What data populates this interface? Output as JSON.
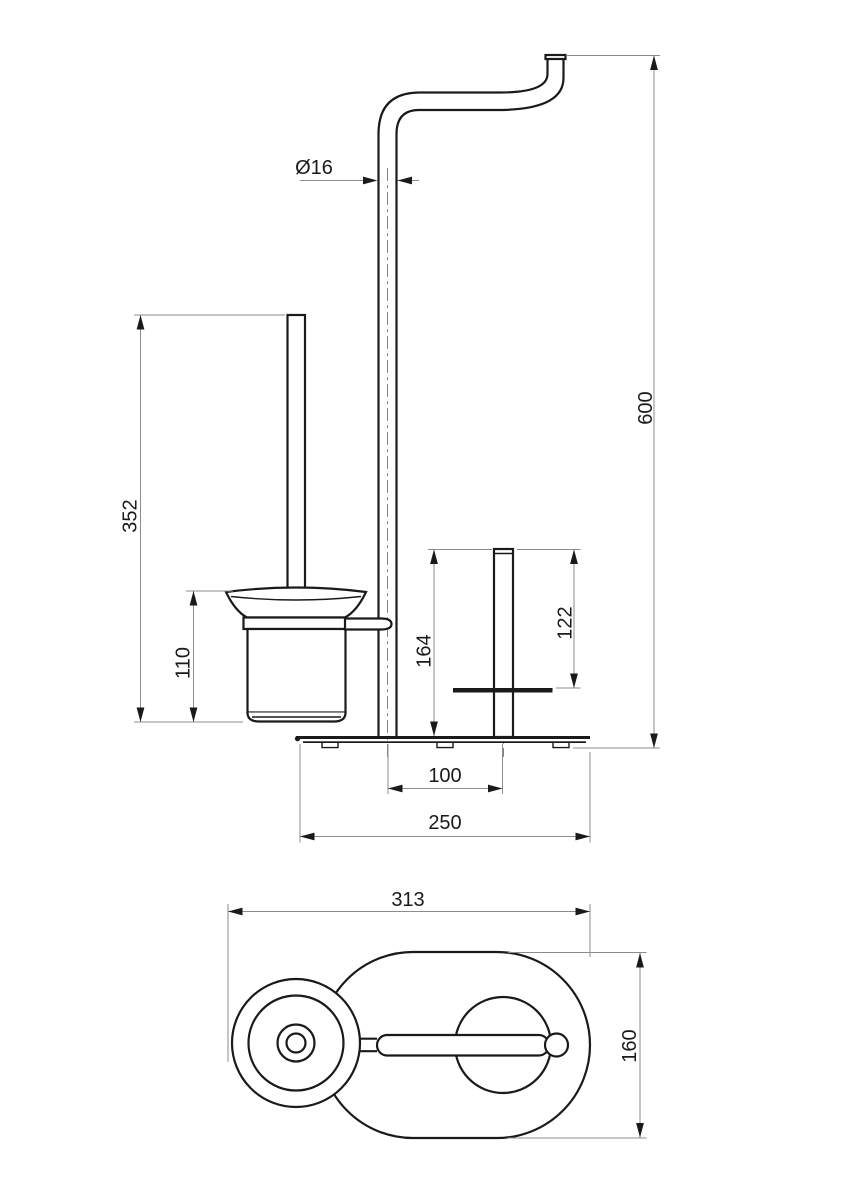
{
  "drawing": {
    "title": "Freestanding toilet brush and roll holder - dimensional drawing",
    "colors": {
      "background": "#ffffff",
      "object_line": "#1a1a1a",
      "dimension_line": "#8c8c8c",
      "text": "#1a1a1a"
    },
    "front_view": {
      "dim_pipe_diameter": "Ø16",
      "dim_total_height": "600",
      "dim_brush_unit_height": "352",
      "dim_cup_height": "110",
      "dim_roll_post_height": "164",
      "dim_roll_post_to_rest": "122",
      "dim_post_spacing": "100",
      "dim_base_length": "250"
    },
    "plan_view": {
      "dim_overall_length": "313",
      "dim_base_width": "160"
    }
  }
}
